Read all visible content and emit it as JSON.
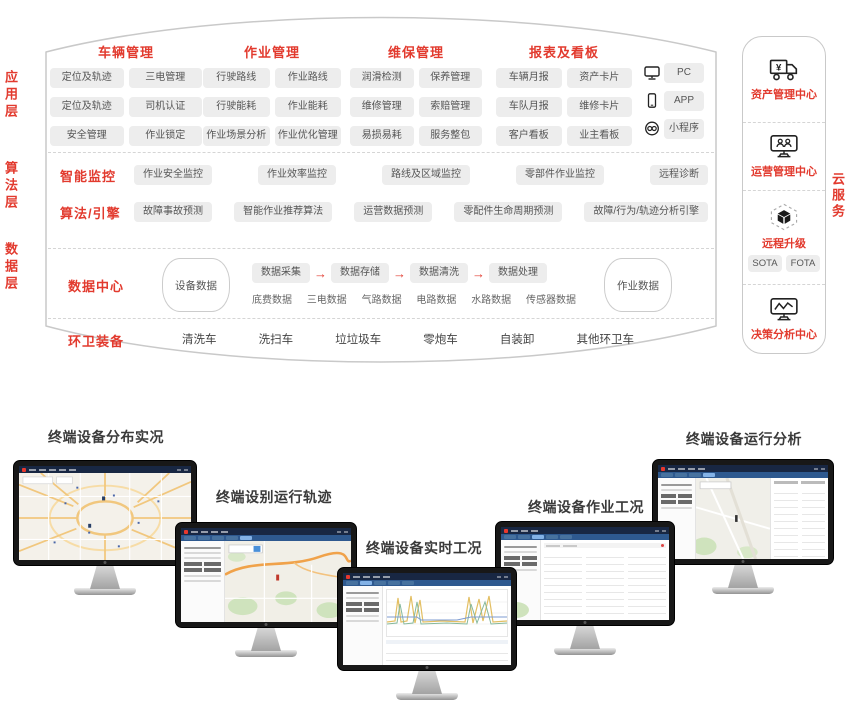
{
  "colors": {
    "accent_red": "#e23a2e",
    "pill_bg": "#ededed",
    "pill_text": "#555555",
    "screen_topbar": "#182743",
    "screen_tabbar": "#2e598f"
  },
  "arch": {
    "layers": [
      {
        "label": "应用层"
      },
      {
        "label": "算法层"
      },
      {
        "label": "数据层"
      }
    ],
    "app": {
      "groups": [
        {
          "title": "车辆管理",
          "pills": [
            "定位及轨迹",
            "三电管理",
            "定位及轨迹",
            "司机认证",
            "安全管理",
            "作业锁定"
          ]
        },
        {
          "title": "作业管理",
          "pills": [
            "行驶路线",
            "作业路线",
            "行驶能耗",
            "作业能耗",
            "作业场景分析",
            "作业优化管理"
          ]
        },
        {
          "title": "维保管理",
          "pills": [
            "润滑检测",
            "保养管理",
            "维修管理",
            "索赔管理",
            "易损易耗",
            "服务整包"
          ]
        },
        {
          "title": "报表及看板",
          "pills": [
            "车辆月报",
            "资产卡片",
            "车队月报",
            "维修卡片",
            "客户看板",
            "业主看板"
          ]
        }
      ],
      "platforms": [
        {
          "icon": "pc-icon",
          "label": "PC"
        },
        {
          "icon": "phone-icon",
          "label": "APP"
        },
        {
          "icon": "mini-program-link-icon",
          "label": "小程序"
        }
      ]
    },
    "algo": {
      "rows": [
        {
          "label": "智能监控",
          "pills": [
            "作业安全监控",
            "作业效率监控",
            "路线及区域监控",
            "零部件作业监控",
            "远程诊断"
          ]
        },
        {
          "label": "算法/引擎",
          "pills": [
            "故障事故预测",
            "智能作业推荐算法",
            "运营数据预测",
            "零配件生命周期预测",
            "故障/行为/轨迹分析引擎"
          ]
        }
      ]
    },
    "data": {
      "label": "数据中心",
      "left_store": "设备数据",
      "flow": [
        "数据采集",
        "数据存储",
        "数据清洗",
        "数据处理"
      ],
      "arrow_glyph": "→",
      "sub": [
        "底费数据",
        "三电数据",
        "气路数据",
        "电路数据",
        "水路数据",
        "传感器数据"
      ],
      "right_store": "作业数据"
    },
    "equip": {
      "label": "环卫装备",
      "items": [
        "清洗车",
        "洗扫车",
        "垃垃圾车",
        "零炮车",
        "自装卸",
        "其他环卫车"
      ]
    },
    "cloud": {
      "side_label": "云服务",
      "sections": [
        {
          "icon": "truck-yen-icon",
          "label": "资产管理中心"
        },
        {
          "icon": "monitor-users-icon",
          "label": "运营管理中心"
        },
        {
          "icon": "cube-upgrade-icon",
          "label": "远程升级",
          "pills": [
            "SOTA",
            "FOTA"
          ]
        },
        {
          "icon": "monitor-chart-icon",
          "label": "决策分析中心"
        }
      ]
    }
  },
  "monitors": [
    {
      "label": "终端设备分布实况",
      "screen": "map-overview"
    },
    {
      "label": "终端设别运行轨迹",
      "screen": "map-track"
    },
    {
      "label": "终端设备实时工况",
      "screen": "realtime-chart"
    },
    {
      "label": "终端设备作业工况",
      "screen": "work-table"
    },
    {
      "label": "终端设备运行分析",
      "screen": "analysis-map"
    }
  ]
}
